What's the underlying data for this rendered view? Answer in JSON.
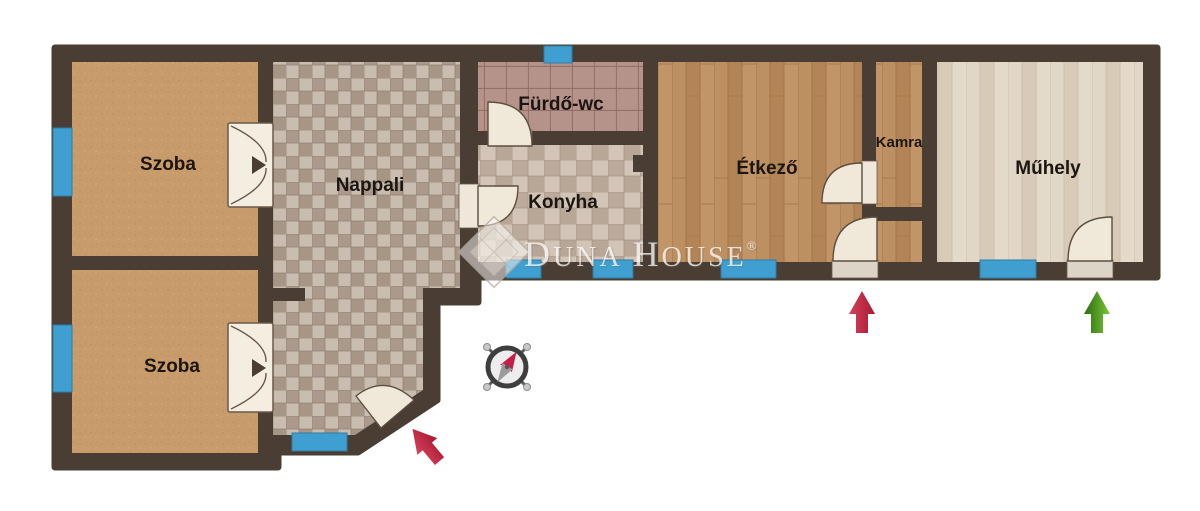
{
  "rooms": {
    "szoba_top": {
      "label": "Szoba"
    },
    "szoba_bottom": {
      "label": "Szoba"
    },
    "nappali": {
      "label": "Nappali"
    },
    "furdo_wc": {
      "label": "Fürdő-wc"
    },
    "konyha": {
      "label": "Konyha"
    },
    "etkezo": {
      "label": "Étkező"
    },
    "kamra": {
      "label": "Kamra"
    },
    "muhely": {
      "label": "Műhely"
    }
  },
  "watermark": {
    "part1": "D",
    "part2": "UNA",
    "part3": "H",
    "part4": "OUSE",
    "registered": "®"
  },
  "markers": {
    "entrance_arrows": [
      {
        "id": "nappali-entrance",
        "color": "#c32544",
        "direction": "up-left"
      },
      {
        "id": "etkezo-entrance",
        "color": "#c32544",
        "direction": "up"
      },
      {
        "id": "muhely-entrance",
        "color": "#57a327",
        "direction": "up"
      }
    ],
    "compass_needle_color": "#c41f49"
  },
  "colors": {
    "wall": "#4a3d33",
    "window": "#3f9fd0",
    "door_fan": "#f0e9da",
    "szoba_floor": "#c89b6b",
    "nappali_tile_light": "#c9bdb0",
    "nappali_tile_dark": "#ab9a8c",
    "bath_tile": "#b28e85",
    "wood_floor": "#bb8d5e",
    "workshop_floor": "#ded3c2"
  }
}
